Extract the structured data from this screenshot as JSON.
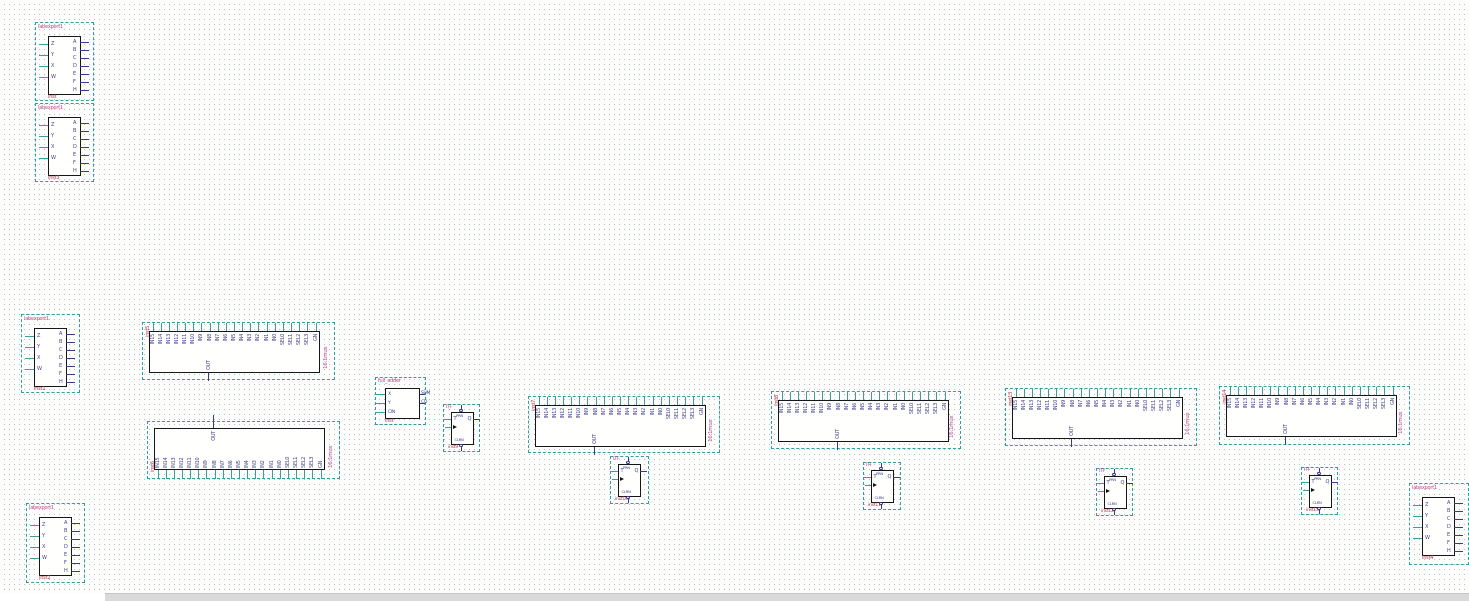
{
  "editor": {
    "background": "#fdfdfc",
    "grid_dot_color": "#b2c0cb",
    "grid_spacing_px": 5
  },
  "colors": {
    "selection_box": "#2f9ea0",
    "pin_input_stub": "#3e9c9c",
    "pin_output_stub": "#3a3a8c",
    "pin_text": "#3f3f8f",
    "type_label": "#b8488e",
    "instance_label": "#b03a4a",
    "body_border": "#15151a",
    "scrollbar": "#d9d9d9"
  },
  "shared": {
    "mux_pins": [
      "IN15",
      "IN14",
      "IN13",
      "IN12",
      "IN11",
      "IN10",
      "IN9",
      "IN8",
      "IN7",
      "IN6",
      "IN5",
      "IN4",
      "IN3",
      "IN2",
      "IN1",
      "IN0",
      "SEL0",
      "SEL1",
      "SEL2",
      "SEL3",
      "GN"
    ],
    "mux_out": "OUT",
    "port_left": [
      "Z",
      "Y",
      "X",
      "W"
    ],
    "port_right": [
      "A",
      "B",
      "C",
      "D",
      "E",
      "F",
      "H"
    ],
    "tff": {
      "t": "T",
      "q": "Q",
      "prn": "PRN",
      "clrn": "CLRN"
    },
    "fa_left": [
      "X",
      "Y",
      "CIN"
    ],
    "fa_right": [
      "SUM",
      "CO"
    ]
  },
  "components": [
    {
      "id": "u1",
      "kind": "port_block",
      "type_label": "labexport1",
      "instance_label": "inst",
      "x": 35,
      "y": 22,
      "w": 57,
      "h": 77
    },
    {
      "id": "u2",
      "kind": "port_block",
      "type_label": "labexport1",
      "instance_label": "inst3",
      "x": 35,
      "y": 103,
      "w": 57,
      "h": 77
    },
    {
      "id": "u3",
      "kind": "port_block",
      "type_label": "labexport1",
      "instance_label": "inst1",
      "x": 21,
      "y": 314,
      "w": 57,
      "h": 77
    },
    {
      "id": "u4",
      "kind": "port_block",
      "type_label": "labexport1",
      "instance_label": "inst2",
      "x": 26,
      "y": 503,
      "w": 57,
      "h": 78
    },
    {
      "id": "u5",
      "kind": "port_block",
      "type_label": "labexport1",
      "instance_label": "inst4",
      "x": 1409,
      "y": 483,
      "w": 58,
      "h": 80
    },
    {
      "id": "m1",
      "kind": "mux16",
      "type_label": "16:1mux",
      "instance_label": "inst5",
      "pins_edge": "top",
      "x": 142,
      "y": 322,
      "w": 191,
      "h": 56
    },
    {
      "id": "m2",
      "kind": "mux16",
      "type_label": "16:1mux",
      "instance_label": "inst6",
      "pins_edge": "bottom",
      "x": 147,
      "y": 421,
      "w": 191,
      "h": 56
    },
    {
      "id": "m3",
      "kind": "mux16",
      "type_label": "16:1mux",
      "instance_label": "inst7",
      "pins_edge": "top",
      "x": 528,
      "y": 396,
      "w": 190,
      "h": 55
    },
    {
      "id": "m4",
      "kind": "mux16",
      "type_label": "16:1mux",
      "instance_label": "inst8",
      "pins_edge": "top",
      "x": 771,
      "y": 391,
      "w": 188,
      "h": 56
    },
    {
      "id": "m5",
      "kind": "mux16",
      "type_label": "16:1mux",
      "instance_label": "inst13",
      "pins_edge": "top",
      "x": 1005,
      "y": 388,
      "w": 190,
      "h": 56
    },
    {
      "id": "m6",
      "kind": "mux16",
      "type_label": "16:1mux",
      "instance_label": "inst14",
      "pins_edge": "top",
      "x": 1219,
      "y": 386,
      "w": 189,
      "h": 57
    },
    {
      "id": "fa1",
      "kind": "full_adder",
      "type_label": "full_adder",
      "instance_label": "inst",
      "x": 375,
      "y": 377,
      "w": 49,
      "h": 46
    },
    {
      "id": "t1",
      "kind": "tff",
      "type_label": "TFF",
      "instance_label": "inst9",
      "x": 443,
      "y": 404,
      "w": 35,
      "h": 46
    },
    {
      "id": "t2",
      "kind": "tff",
      "type_label": "TFF",
      "instance_label": "inst10",
      "x": 610,
      "y": 456,
      "w": 37,
      "h": 46
    },
    {
      "id": "t3",
      "kind": "tff",
      "type_label": "TFF",
      "instance_label": "inst11",
      "x": 863,
      "y": 462,
      "w": 36,
      "h": 46
    },
    {
      "id": "t4",
      "kind": "tff",
      "type_label": "TFF",
      "instance_label": "inst12",
      "x": 1096,
      "y": 468,
      "w": 35,
      "h": 46
    },
    {
      "id": "t5",
      "kind": "tff",
      "type_label": "TFF",
      "instance_label": "inst15",
      "x": 1301,
      "y": 467,
      "w": 35,
      "h": 46
    }
  ],
  "scrollbar": {
    "left_gap_px": 105
  }
}
